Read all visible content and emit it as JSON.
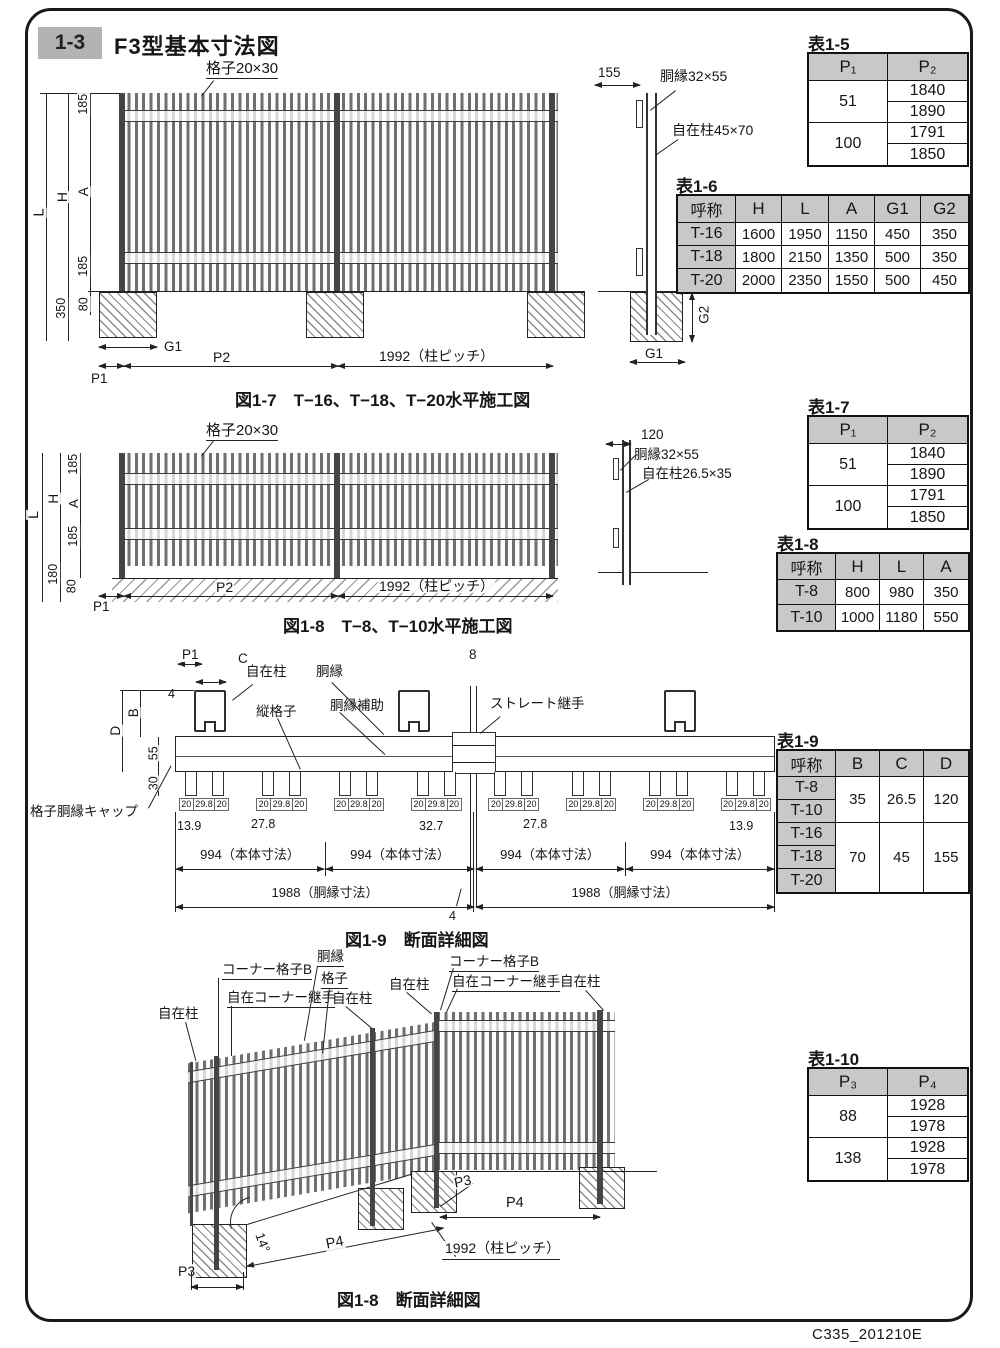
{
  "page": {
    "section_no": "1-3",
    "title": "F3型基本寸法図",
    "doc_code": "C335_201210E"
  },
  "fig_1_7": {
    "caption": "図1-7　T−16、T−18、T−20水平施工図",
    "grid_label": "格子20×30",
    "dim_L": "L",
    "dim_H": "H",
    "dim_A": "A",
    "dim_185_top": "185",
    "dim_185_bottom": "185",
    "dim_350": "350",
    "dim_80": "80",
    "dim_P1": "P1",
    "dim_G1": "G1",
    "dim_P2": "P2",
    "dim_pitch": "1992（柱ピッチ）",
    "side": {
      "dim_155": "155",
      "rail_label": "胴縁32×55",
      "post_label": "自在柱45×70",
      "dim_G2": "G2",
      "dim_G1": "G1"
    }
  },
  "fig_1_8": {
    "caption": "図1-8　T−8、T−10水平施工図",
    "grid_label": "格子20×30",
    "dim_L": "L",
    "dim_H": "H",
    "dim_A": "A",
    "dim_185_top": "185",
    "dim_185_bottom": "185",
    "dim_180": "180",
    "dim_80": "80",
    "dim_P1": "P1",
    "dim_P2": "P2",
    "dim_pitch": "1992（柱ピッチ）",
    "side": {
      "dim_120": "120",
      "rail_label": "胴縁32×55",
      "post_label": "自在柱26.5×35"
    }
  },
  "fig_1_9": {
    "caption": "図1-9　断面詳細図",
    "dim_P1": "P1",
    "dim_C": "C",
    "dim_4_top": "4",
    "dim_8": "8",
    "post_label": "自在柱",
    "rail_label": "胴縁",
    "grid_label": "縦格子",
    "rail_sub_label": "胴縁補助",
    "joint_label": "ストレート継手",
    "dim_B": "B",
    "dim_D": "D",
    "dim_55": "55",
    "dim_30": "30",
    "cap_label": "格子胴縁キャップ",
    "picket_groups": [
      [
        "20",
        "29.8",
        "20"
      ],
      [
        "20",
        "29.8",
        "20"
      ],
      [
        "20",
        "29.8",
        "20"
      ],
      [
        "20",
        "29.8",
        "20"
      ],
      [
        "20",
        "29.8",
        "20"
      ],
      [
        "20",
        "29.8",
        "20"
      ],
      [
        "20",
        "29.8",
        "20"
      ],
      [
        "20",
        "29.8",
        "20"
      ]
    ],
    "gap_dims": [
      "13.9",
      "27.8",
      "32.7",
      "27.8",
      "13.9"
    ],
    "body_dims": [
      "994（本体寸法）",
      "994（本体寸法）",
      "994（本体寸法）",
      "994（本体寸法）"
    ],
    "rail_dims": [
      "1988（胴縁寸法）",
      "1988（胴縁寸法）"
    ],
    "dim_4_bottom": "4"
  },
  "fig_1_8b": {
    "caption": "図1-8　断面詳細図",
    "post_label_1": "自在柱",
    "corner_grid_label_1": "コーナー格子B",
    "corner_joint_label_1": "自在コーナー継手",
    "rail_label": "胴縁",
    "grid_label": "格子",
    "post_label_2": "自在柱",
    "post_label_3": "自在柱",
    "corner_grid_label_2": "コーナー格子B",
    "corner_joint_label_2": "自在コーナー継手",
    "post_label_4": "自在柱",
    "dim_P3_left": "P3",
    "dim_P4_slope": "P4",
    "dim_angle": "14°",
    "dim_P3_right": "P3",
    "dim_P4_right": "P4",
    "dim_pitch": "1992（柱ピッチ）"
  },
  "table_1_5": {
    "title": "表1-5",
    "col1": "P₁",
    "col2": "P₂",
    "rows": [
      {
        "p1": "51",
        "p2": [
          "1840",
          "1890"
        ]
      },
      {
        "p1": "100",
        "p2": [
          "1791",
          "1850"
        ]
      }
    ]
  },
  "table_1_6": {
    "title": "表1-6",
    "headers": [
      "呼称",
      "H",
      "L",
      "A",
      "G1",
      "G2"
    ],
    "rows": [
      [
        "T-16",
        "1600",
        "1950",
        "1150",
        "450",
        "350"
      ],
      [
        "T-18",
        "1800",
        "2150",
        "1350",
        "500",
        "350"
      ],
      [
        "T-20",
        "2000",
        "2350",
        "1550",
        "500",
        "450"
      ]
    ]
  },
  "table_1_7": {
    "title": "表1-7",
    "col1": "P₁",
    "col2": "P₂",
    "rows": [
      {
        "p1": "51",
        "p2": [
          "1840",
          "1890"
        ]
      },
      {
        "p1": "100",
        "p2": [
          "1791",
          "1850"
        ]
      }
    ]
  },
  "table_1_8": {
    "title": "表1-8",
    "headers": [
      "呼称",
      "H",
      "L",
      "A"
    ],
    "rows": [
      [
        "T-8",
        "800",
        "980",
        "350"
      ],
      [
        "T-10",
        "1000",
        "1180",
        "550"
      ]
    ]
  },
  "table_1_9": {
    "title": "表1-9",
    "headers": [
      "呼称",
      "B",
      "C",
      "D"
    ],
    "names": [
      "T-8",
      "T-10",
      "T-16",
      "T-18",
      "T-20"
    ],
    "groups": [
      {
        "B": "35",
        "C": "26.5",
        "D": "120"
      },
      {
        "B": "70",
        "C": "45",
        "D": "155"
      }
    ]
  },
  "table_1_10": {
    "title": "表1-10",
    "col1": "P₃",
    "col2": "P₄",
    "rows": [
      {
        "p3": "88",
        "p4": [
          "1928",
          "1978"
        ]
      },
      {
        "p3": "138",
        "p4": [
          "1928",
          "1978"
        ]
      }
    ]
  }
}
